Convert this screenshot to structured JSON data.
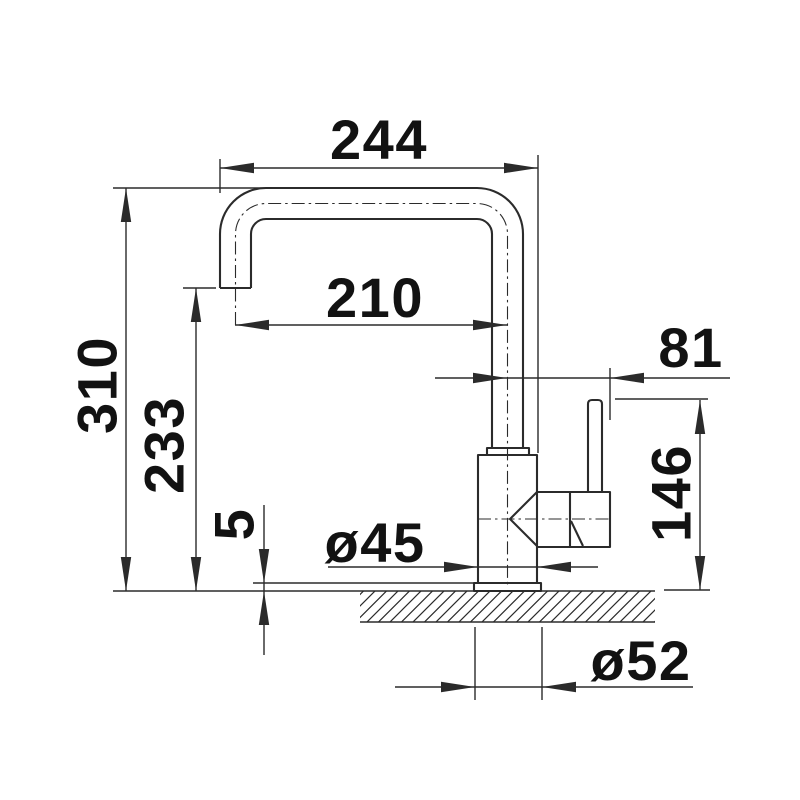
{
  "colors": {
    "background": "#ffffff",
    "line": "#2b2b2b",
    "text": "#121212"
  },
  "drawing": {
    "kind": "faucet-dimension-drawing",
    "dimensions": {
      "spout_reach": "244",
      "spout_projection": "210",
      "handle_offset": "81",
      "total_height": "310",
      "outlet_height": "233",
      "base_plate_height": "5",
      "handle_height": "146",
      "body_diameter": "ø45",
      "hole_diameter": "ø52"
    }
  }
}
